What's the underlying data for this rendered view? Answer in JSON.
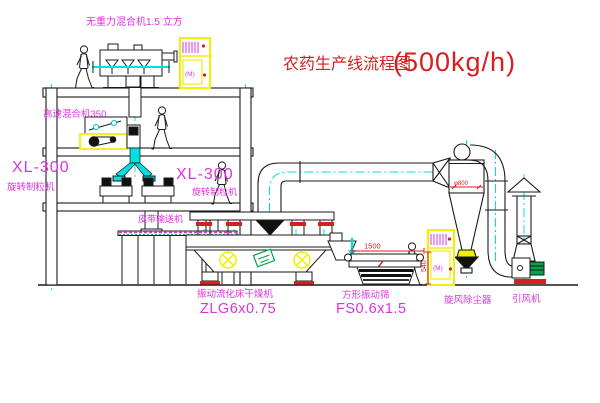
{
  "title": {
    "name": "农药生产线流程图",
    "capacity": "(500kg/h)"
  },
  "equipment_labels": {
    "gravity_free_mixer": "无重力混合机1.5 立方",
    "high_speed_mixer": "高速混合机350",
    "granulator_left_model": "XL-300",
    "granulator_left_name": "旋转制粒机",
    "granulator_right_model": "XL-300",
    "granulator_right_name": "旋转制粒机",
    "belt_conveyor": "皮带输送机",
    "fluid_bed_dryer_name": "振动流化床干燥机",
    "fluid_bed_dryer_model": "ZLG6x0.75",
    "vibrating_screen_name": "方形振动筛",
    "vibrating_screen_model": "FS0.6x1.5",
    "cyclone_collector": "旋风除尘器",
    "induced_draft_fan": "引风机"
  },
  "dimensions": {
    "screen_length": "1500",
    "screen_height": "540",
    "cyclone_note": "φ800"
  },
  "cabinet_mark": "(M)",
  "colors": {
    "line": "#1a1a1a",
    "cyan": "#00e0e0",
    "magenta": "#dd33dd",
    "red": "#d42020",
    "yellow": "#f0f000",
    "green": "#00a44a"
  }
}
